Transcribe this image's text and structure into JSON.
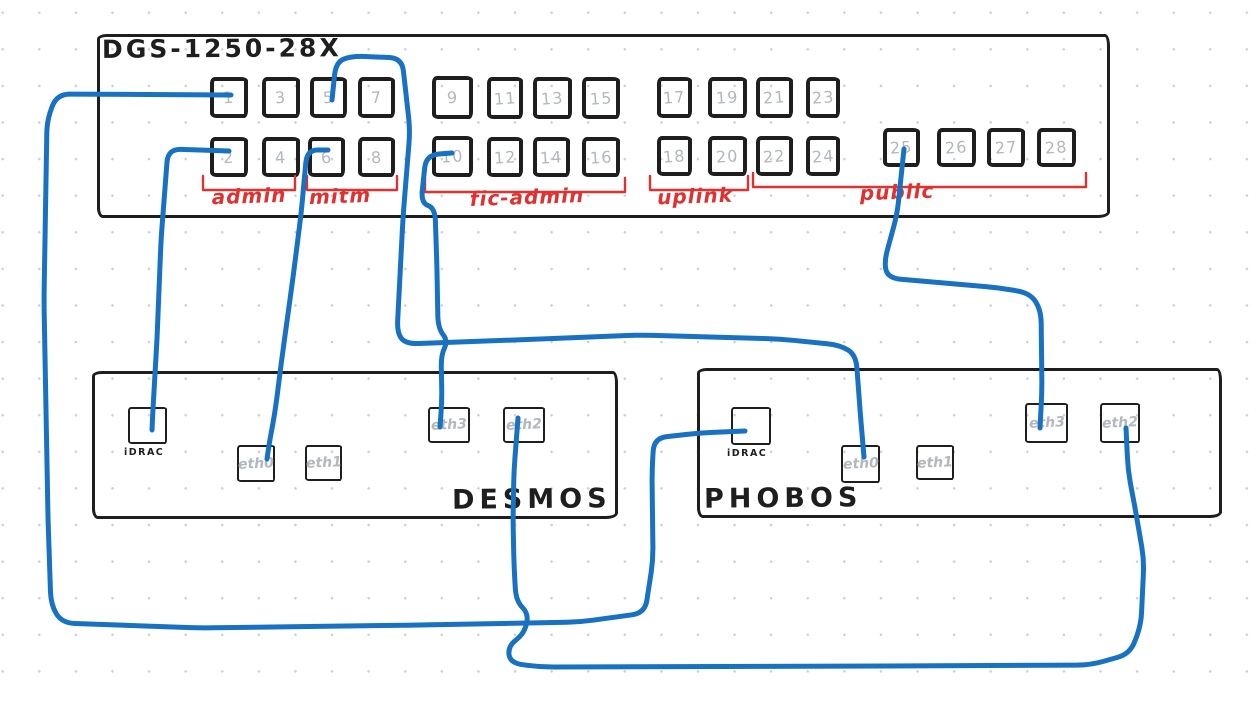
{
  "diagram": {
    "canvas": {
      "width": 1256,
      "height": 703,
      "background": "#ffffff"
    },
    "colors": {
      "ink": "#1e1e1e",
      "cable_blue": "#1971c2",
      "group_red": "#e03131",
      "port_number_gray": "#b2b8be"
    },
    "switch": {
      "name": "DGS-1250-28X",
      "title_pos": {
        "x": 102,
        "y": 34
      },
      "box": {
        "x": 97,
        "y": 34,
        "w": 1013,
        "h": 184
      },
      "ports": [
        {
          "id": "1",
          "x": 210,
          "y": 77,
          "w": 38,
          "h": 41
        },
        {
          "id": "3",
          "x": 262,
          "y": 77,
          "w": 38,
          "h": 41
        },
        {
          "id": "5",
          "x": 310,
          "y": 77,
          "w": 37,
          "h": 41
        },
        {
          "id": "7",
          "x": 358,
          "y": 77,
          "w": 37,
          "h": 41
        },
        {
          "id": "9",
          "x": 432,
          "y": 76,
          "w": 41,
          "h": 43
        },
        {
          "id": "11",
          "x": 487,
          "y": 77,
          "w": 36,
          "h": 42
        },
        {
          "id": "13",
          "x": 533,
          "y": 77,
          "w": 39,
          "h": 42
        },
        {
          "id": "15",
          "x": 582,
          "y": 77,
          "w": 38,
          "h": 42
        },
        {
          "id": "17",
          "x": 657,
          "y": 77,
          "w": 35,
          "h": 41
        },
        {
          "id": "19",
          "x": 708,
          "y": 77,
          "w": 39,
          "h": 41
        },
        {
          "id": "21",
          "x": 756,
          "y": 77,
          "w": 37,
          "h": 41
        },
        {
          "id": "23",
          "x": 806,
          "y": 77,
          "w": 34,
          "h": 41
        },
        {
          "id": "2",
          "x": 210,
          "y": 137,
          "w": 38,
          "h": 40
        },
        {
          "id": "4",
          "x": 262,
          "y": 137,
          "w": 38,
          "h": 40
        },
        {
          "id": "6",
          "x": 308,
          "y": 137,
          "w": 37,
          "h": 40
        },
        {
          "id": "8",
          "x": 358,
          "y": 137,
          "w": 37,
          "h": 40
        },
        {
          "id": "10",
          "x": 432,
          "y": 136,
          "w": 41,
          "h": 41
        },
        {
          "id": "12",
          "x": 487,
          "y": 137,
          "w": 36,
          "h": 40
        },
        {
          "id": "14",
          "x": 533,
          "y": 137,
          "w": 37,
          "h": 40
        },
        {
          "id": "16",
          "x": 582,
          "y": 137,
          "w": 38,
          "h": 40
        },
        {
          "id": "18",
          "x": 657,
          "y": 136,
          "w": 35,
          "h": 40
        },
        {
          "id": "20",
          "x": 708,
          "y": 136,
          "w": 39,
          "h": 40
        },
        {
          "id": "22",
          "x": 756,
          "y": 136,
          "w": 37,
          "h": 40
        },
        {
          "id": "24",
          "x": 806,
          "y": 136,
          "w": 34,
          "h": 40
        },
        {
          "id": "25",
          "x": 883,
          "y": 128,
          "w": 37,
          "h": 39
        },
        {
          "id": "26",
          "x": 937,
          "y": 128,
          "w": 39,
          "h": 39
        },
        {
          "id": "27",
          "x": 987,
          "y": 128,
          "w": 38,
          "h": 39
        },
        {
          "id": "28",
          "x": 1037,
          "y": 128,
          "w": 39,
          "h": 39
        }
      ],
      "groups": [
        {
          "label": "admin",
          "x1": 203,
          "x2": 295,
          "y": 190,
          "cx": 249,
          "ty": 184
        },
        {
          "label": "mitm",
          "x1": 307,
          "x2": 397,
          "y": 190,
          "cx": 340,
          "ty": 184
        },
        {
          "label": "fic-admin",
          "x1": 425,
          "x2": 625,
          "y": 192,
          "cx": 527,
          "ty": 185
        },
        {
          "label": "uplink",
          "x1": 650,
          "x2": 748,
          "y": 190,
          "cx": 695,
          "ty": 184
        },
        {
          "label": "public",
          "x1": 753,
          "x2": 1086,
          "y": 187,
          "cx": 897,
          "ty": 180
        }
      ]
    },
    "servers": [
      {
        "id": "desmos",
        "name": "DESMOS",
        "box": {
          "x": 92,
          "y": 371,
          "w": 526,
          "h": 148
        },
        "name_pos": {
          "x": 452,
          "y": 484
        },
        "ports": [
          {
            "id": "idrac",
            "label": "iDRAC",
            "label_placement": "below",
            "x": 128,
            "y": 407,
            "w": 39,
            "h": 37
          },
          {
            "id": "eth0",
            "label": "eth0",
            "label_placement": "inside",
            "x": 237,
            "y": 445,
            "w": 38,
            "h": 37
          },
          {
            "id": "eth1",
            "label": "eth1",
            "label_placement": "inside",
            "x": 305,
            "y": 445,
            "w": 37,
            "h": 36
          },
          {
            "id": "eth3",
            "label": "eth3",
            "label_placement": "inside",
            "x": 428,
            "y": 407,
            "w": 42,
            "h": 36
          },
          {
            "id": "eth2",
            "label": "eth2",
            "label_placement": "inside",
            "x": 503,
            "y": 407,
            "w": 42,
            "h": 36
          }
        ]
      },
      {
        "id": "phobos",
        "name": "PHOBOS",
        "box": {
          "x": 697,
          "y": 368,
          "w": 525,
          "h": 150
        },
        "name_pos": {
          "x": 704,
          "y": 483
        },
        "ports": [
          {
            "id": "idrac",
            "label": "iDRAC",
            "label_placement": "below",
            "x": 731,
            "y": 407,
            "w": 40,
            "h": 38
          },
          {
            "id": "eth0",
            "label": "eth0",
            "label_placement": "inside",
            "x": 841,
            "y": 445,
            "w": 39,
            "h": 38
          },
          {
            "id": "eth1",
            "label": "eth1",
            "label_placement": "inside",
            "x": 916,
            "y": 445,
            "w": 38,
            "h": 35
          },
          {
            "id": "eth3",
            "label": "eth3",
            "label_placement": "inside",
            "x": 1025,
            "y": 403,
            "w": 43,
            "h": 40
          },
          {
            "id": "eth2",
            "label": "eth2",
            "label_placement": "inside",
            "x": 1100,
            "y": 403,
            "w": 40,
            "h": 40
          }
        ]
      }
    ],
    "cables": [
      {
        "name": "cable-switch-port1-phobos-idrac",
        "from": "switch port 1",
        "to": "PHOBOS iDRAC",
        "points": [
          [
            231,
            95
          ],
          [
            57,
            94
          ],
          [
            47,
            120
          ],
          [
            44,
            300
          ],
          [
            48,
            520
          ],
          [
            51,
            605
          ],
          [
            62,
            623
          ],
          [
            200,
            628
          ],
          [
            420,
            625
          ],
          [
            580,
            622
          ],
          [
            645,
            613
          ],
          [
            653,
            560
          ],
          [
            652,
            470
          ],
          [
            654,
            438
          ],
          [
            700,
            433
          ],
          [
            745,
            431
          ]
        ]
      },
      {
        "name": "cable-switch-port2-desmos-idrac",
        "from": "switch port 2",
        "to": "DESMOS iDRAC",
        "points": [
          [
            229,
            151
          ],
          [
            168,
            149
          ],
          [
            161,
            240
          ],
          [
            157,
            340
          ],
          [
            153,
            408
          ],
          [
            152,
            430
          ]
        ]
      },
      {
        "name": "cable-switch-port5-phobos-eth0",
        "from": "switch port 5",
        "to": "PHOBOS eth0",
        "points": [
          [
            332,
            100
          ],
          [
            336,
            62
          ],
          [
            352,
            56
          ],
          [
            402,
            58
          ],
          [
            410,
            130
          ],
          [
            403,
            218
          ],
          [
            397,
            333
          ],
          [
            406,
            344
          ],
          [
            540,
            339
          ],
          [
            640,
            335
          ],
          [
            780,
            339
          ],
          [
            840,
            345
          ],
          [
            856,
            355
          ],
          [
            860,
            410
          ],
          [
            864,
            457
          ]
        ]
      },
      {
        "name": "cable-switch-port6-desmos-eth0",
        "from": "switch port 6",
        "to": "DESMOS eth0",
        "points": [
          [
            328,
            150
          ],
          [
            307,
            150
          ],
          [
            301,
            215
          ],
          [
            292,
            285
          ],
          [
            283,
            350
          ],
          [
            275,
            412
          ],
          [
            269,
            445
          ],
          [
            267,
            459
          ]
        ]
      },
      {
        "name": "cable-switch-port10-desmos-eth3",
        "from": "switch port 10",
        "to": "DESMOS eth3",
        "points": [
          [
            452,
            153
          ],
          [
            426,
            155
          ],
          [
            421,
            203
          ],
          [
            435,
            208
          ],
          [
            437,
            270
          ],
          [
            438,
            328
          ],
          [
            448,
            341
          ],
          [
            441,
            355
          ],
          [
            442,
            400
          ],
          [
            440,
            427
          ]
        ]
      },
      {
        "name": "cable-switch-port25-phobos-eth3",
        "from": "switch port 25",
        "to": "PHOBOS eth3",
        "points": [
          [
            904,
            149
          ],
          [
            897,
            215
          ],
          [
            884,
            262
          ],
          [
            888,
            278
          ],
          [
            1000,
            288
          ],
          [
            1030,
            293
          ],
          [
            1041,
            310
          ],
          [
            1042,
            390
          ],
          [
            1040,
            428
          ]
        ]
      },
      {
        "name": "cable-desmos-eth2-phobos-eth2",
        "from": "DESMOS eth2",
        "to": "PHOBOS eth2",
        "points": [
          [
            518,
            418
          ],
          [
            514,
            470
          ],
          [
            513,
            519
          ],
          [
            514,
            565
          ],
          [
            516,
            601
          ],
          [
            529,
            614
          ],
          [
            524,
            634
          ],
          [
            508,
            646
          ],
          [
            510,
            663
          ],
          [
            540,
            667
          ],
          [
            900,
            666
          ],
          [
            1090,
            665
          ],
          [
            1130,
            654
          ],
          [
            1141,
            625
          ],
          [
            1144,
            560
          ],
          [
            1137,
            519
          ],
          [
            1128,
            470
          ],
          [
            1126,
            428
          ]
        ]
      }
    ]
  }
}
